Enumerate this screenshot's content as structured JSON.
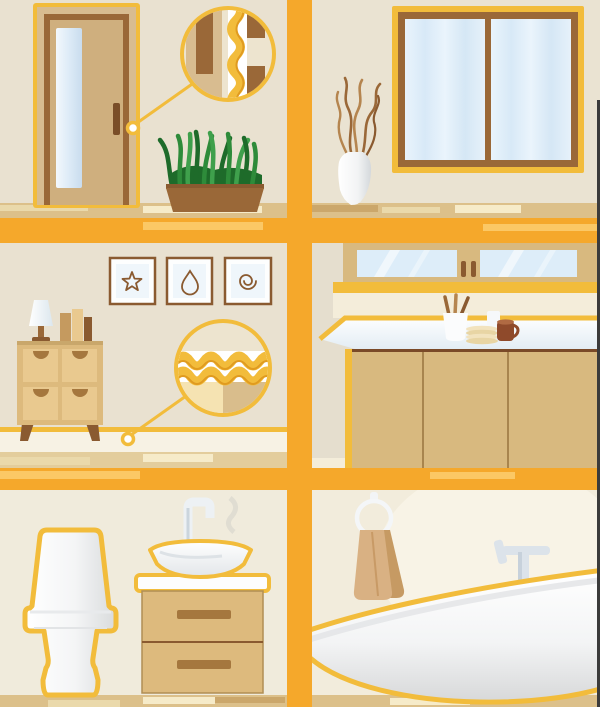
{
  "illustration": {
    "description": "Flat infographic illustration of six home interior scenes arranged in a 2x3 grid separated by orange beams; magnifier callouts highlight yellow weatherstripping seals at a door jamb and at a baseboard",
    "panels": [
      {
        "id": "entry-door",
        "position": "top-left",
        "objects": [
          "door",
          "door-glass-panel",
          "door-handle",
          "seal-magnifier-callout",
          "door-jamb-weatherstrip",
          "grass-planter"
        ]
      },
      {
        "id": "window-room",
        "position": "top-right",
        "objects": [
          "double-pane-window",
          "vase",
          "dry-branches"
        ]
      },
      {
        "id": "living-room",
        "position": "middle-left",
        "objects": [
          "wall-art-star",
          "wall-art-droplet",
          "wall-art-spiral",
          "table-lamp",
          "books",
          "dresser",
          "baseboard-seal-magnifier-callout",
          "baseboard-weatherstrip"
        ]
      },
      {
        "id": "kitchen",
        "position": "middle-right",
        "objects": [
          "upper-glass-cabinets",
          "countertop",
          "utensil-crock",
          "plate-stack",
          "cup",
          "mug",
          "lower-cabinets"
        ]
      },
      {
        "id": "bathroom-vanity",
        "position": "bottom-left",
        "objects": [
          "toilet",
          "vessel-sink",
          "sink-faucet",
          "vanity-drawers"
        ]
      },
      {
        "id": "bathtub-room",
        "position": "bottom-right",
        "objects": [
          "towel-ring",
          "towel",
          "tub-faucet",
          "bathtub"
        ]
      }
    ],
    "callouts": [
      {
        "id": "door-seal",
        "anchor": "door latch edge",
        "detail": "yellow zig-zag weatherstrip between door slab and jamb"
      },
      {
        "id": "baseboard-seal",
        "anchor": "baseboard",
        "detail": "yellow wave seal strip along floor joint"
      }
    ]
  },
  "colors": {
    "accent_orange": "#F5A82B",
    "accent_yellow": "#F2BC3B",
    "seal_shadow": "#E09B20",
    "wall_beige": "#E9E1D0",
    "wall_beige2": "#EAE3D2",
    "wall_cream": "#F0EBDC",
    "wall_cream2": "#F2ECDC",
    "wall_blob": "#F8F3E6",
    "kitchen_wall": "#E5DECE",
    "backsplash": "#F4EDDA",
    "floor_tan": "#DCC08A",
    "floor_light": "#EAD9AB",
    "floor_cream": "#F6EBC9",
    "floor_dark": "#CBA76B",
    "wood_brown": "#9A6838",
    "wood_dark": "#7A4E28",
    "frame_tan": "#D8BC90",
    "door_slab": "#CFAF7E",
    "cabinet_tan": "#D8B97F",
    "dresser_tan": "#DDBA7D",
    "drawer_tan": "#E9C98F",
    "handle_brown": "#A5773E",
    "glass_blue": "#DDEDF9",
    "glass_blue_dark": "#C9DCEE",
    "white": "#FDFDFD",
    "gray_shade": "#D8D8D8",
    "towel": "#D9B183",
    "towel_dark": "#C69A63",
    "grass_dark": "#1E6B2A",
    "grass_mid": "#2E8B3A",
    "grass_light": "#3FA04C",
    "magnifier_bg": "#EDE4CF",
    "mug_brown": "#8F4A2B",
    "plate_cream": "#F2E3BE",
    "fixture_gray": "#DCE3EA",
    "fixture_gray_dark": "#B9C4D0",
    "edge_dark": "#3B3B3B"
  }
}
